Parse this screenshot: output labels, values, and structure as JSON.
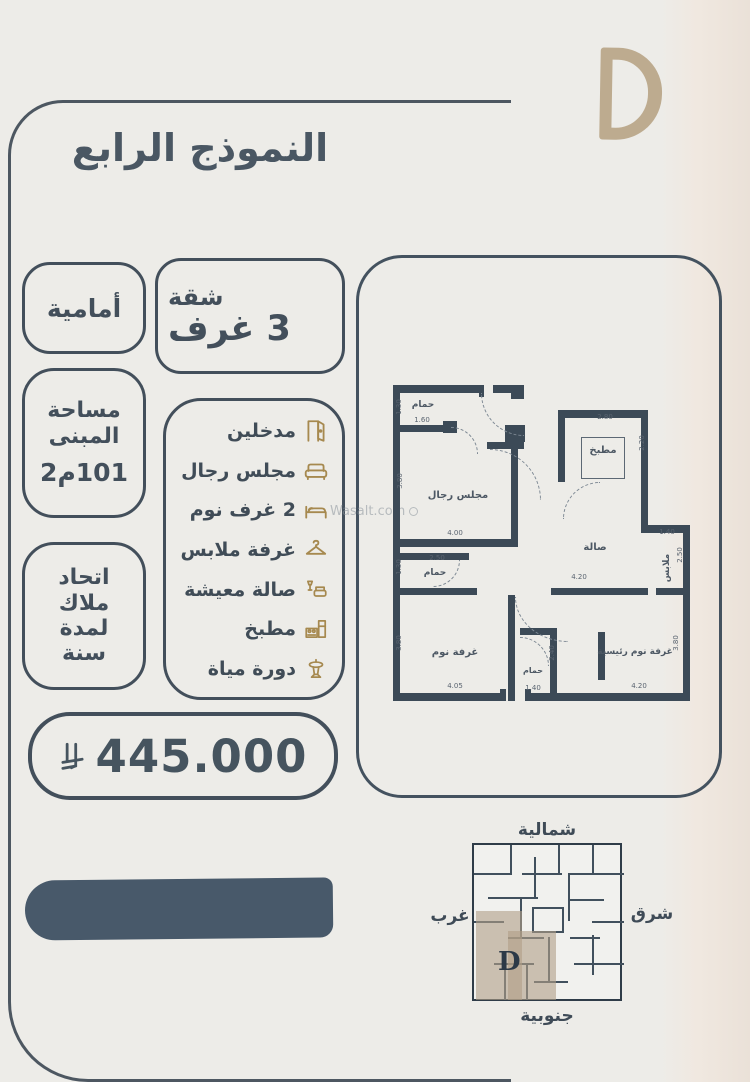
{
  "logo": {
    "letter": "D"
  },
  "title": "النموذج الرابع",
  "side_badges": {
    "facade": "أمامية",
    "area_line1": "مساحة",
    "area_line2": "المبنى",
    "area_value": "101م2",
    "hoa_line1": "اتحاد",
    "hoa_line2": "ملاك",
    "hoa_line3": "لمدة",
    "hoa_line4": "سنة"
  },
  "apartment_box": {
    "type": "شقة",
    "rooms": "3 غرف"
  },
  "features": [
    {
      "label": "مدخلين",
      "icon": "door-icon"
    },
    {
      "label": "مجلس رجال",
      "icon": "sofa-icon"
    },
    {
      "label": "2 غرف نوم",
      "icon": "bed-icon"
    },
    {
      "label": "غرفة ملابس",
      "icon": "hanger-icon"
    },
    {
      "label": "صالة معيشة",
      "icon": "living-room-icon"
    },
    {
      "label": "مطبخ",
      "icon": "kitchen-icon"
    },
    {
      "label": "دورة مياة",
      "icon": "washbasin-icon"
    }
  ],
  "price": {
    "amount": "445.000",
    "currency_icon": "saudi-riyal-symbol"
  },
  "watermark": "Wasalt.com",
  "floor_plan": {
    "rooms": [
      {
        "name": "حمام",
        "dim_v": "1.30",
        "dim_h": "1.60"
      },
      {
        "name": "مجلس رجال",
        "dim_v": "3.80",
        "dim_h": "4.00"
      },
      {
        "name": "مطبخ",
        "dim_h": "2.80",
        "dim_v": "2.20"
      },
      {
        "name": "صالة",
        "dim_h": "4.20"
      },
      {
        "name": "حمام",
        "dim_h": "2.50",
        "dim_v": "1.30"
      },
      {
        "name": "ملابس",
        "dim_h": "1.40",
        "dim_v": "2.50"
      },
      {
        "name": "غرفة نوم",
        "dim_v": "3.80",
        "dim_h": "4.05"
      },
      {
        "name": "حمام",
        "dim_v": "2.40",
        "dim_h": "1.40"
      },
      {
        "name": "غرفة نوم رئيسية",
        "dim_v": "3.80",
        "dim_h": "4.20"
      }
    ]
  },
  "key_plan": {
    "north": "شمالية",
    "south": "جنوبية",
    "east": "شرق",
    "west": "غرب",
    "unit_letter": "D"
  },
  "colors": {
    "navy": "#42505d",
    "gold": "#a6894f",
    "tan_logo": "#bdab8f",
    "unit_highlight": "#b19f87",
    "background": "#edece8"
  }
}
